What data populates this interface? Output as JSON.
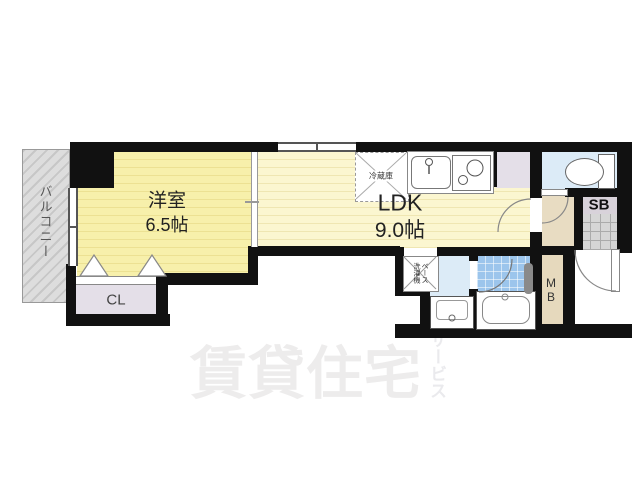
{
  "floorplan": {
    "balcony": {
      "label": "バルコニー"
    },
    "western_room": {
      "label": "洋室",
      "size": "6.5帖"
    },
    "ldk": {
      "label": "LDK",
      "size": "9.0帖"
    },
    "closet": {
      "label": "CL"
    },
    "kitchen": {
      "fridge_label": "冷蔵庫"
    },
    "laundry": {
      "full_label": "洗濯機ベース",
      "column_right": "ベース",
      "column_left": "洗濯機"
    },
    "shoe_box": {
      "label": "SB"
    },
    "meter_box": {
      "label": "MB",
      "line1": "M",
      "line2": "B"
    },
    "watermark": {
      "main": "賃貸住宅",
      "sub": "サービス"
    }
  },
  "colors": {
    "wall": "#111111",
    "western_room_fill": "#f7f0ab",
    "ldk_fill": "#fbf6d0",
    "balcony_fill": "#d7d7d7",
    "closet_fill": "#e4dfe8",
    "hall_fill": "#e8dcc2",
    "meter_box_fill": "#e6d9bd",
    "toilet_washroom_fill": "#dcebf7",
    "bath_tile_fill": "#9cc5ec",
    "entrance_tile_fill": "#d6d6d6",
    "watermark_color": "#edecec"
  }
}
